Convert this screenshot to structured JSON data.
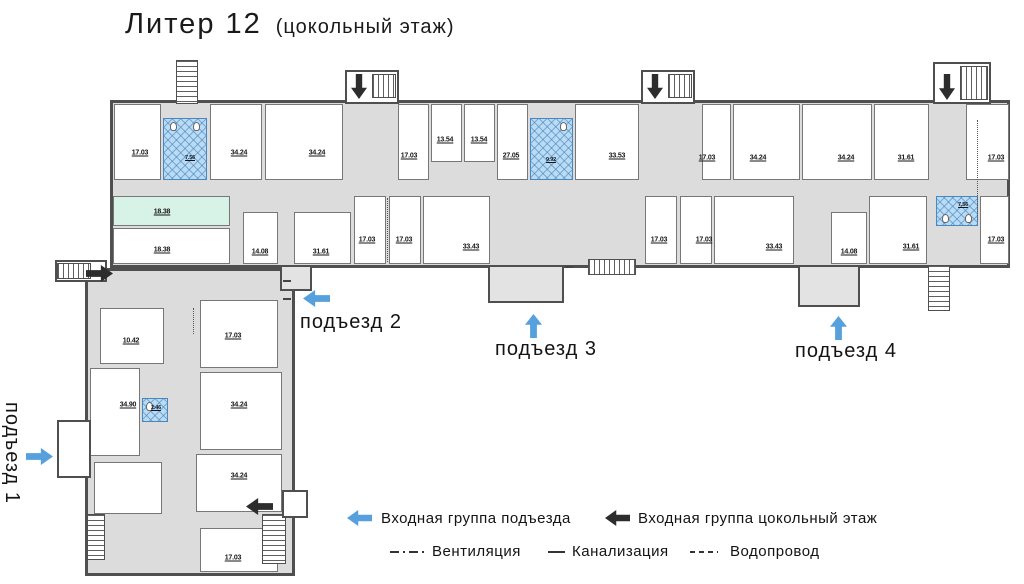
{
  "title": {
    "main": "Литер 12",
    "sub": "(цокольный этаж)"
  },
  "entrances": {
    "e1": "подъезд 1",
    "e2": "подъезд 2",
    "e3": "подъезд 3",
    "e4": "подъезд 4"
  },
  "legend": {
    "porch_entry": "Входная группа подъезда",
    "basement_entry": "Входная группа цокольный этаж",
    "ventilation": "Вентиляция",
    "sewer": "Канализация",
    "water": "Водопровод"
  },
  "colors": {
    "entry_arrow_blue": "#55a0dd",
    "entry_arrow_black": "#2d2d2d",
    "wet_room_fill": "#b9dcf6",
    "green_room_fill": "#d7f3e7",
    "wall": "#4f4f4f",
    "corridor_fill": "#dcdcdc"
  },
  "rooms": {
    "top": [
      "17.03",
      "7.56",
      "34.24",
      "34.24",
      "17.03",
      "13.54",
      "13.54",
      "27.05",
      "9.92",
      "33.53",
      "17.03",
      "34.24",
      "34.24",
      "31.61",
      "17.03"
    ],
    "bottom": [
      "18.38",
      "18.38",
      "14.08",
      "31.61",
      "17.03",
      "17.03",
      "33.43",
      "17.03",
      "17.03",
      "33.43",
      "14.08",
      "31.61",
      "7.56",
      "17.03"
    ],
    "wing": [
      "10.42",
      "17.03",
      "34.90",
      "2.46",
      "34.24",
      "34.24",
      "17.03"
    ]
  }
}
